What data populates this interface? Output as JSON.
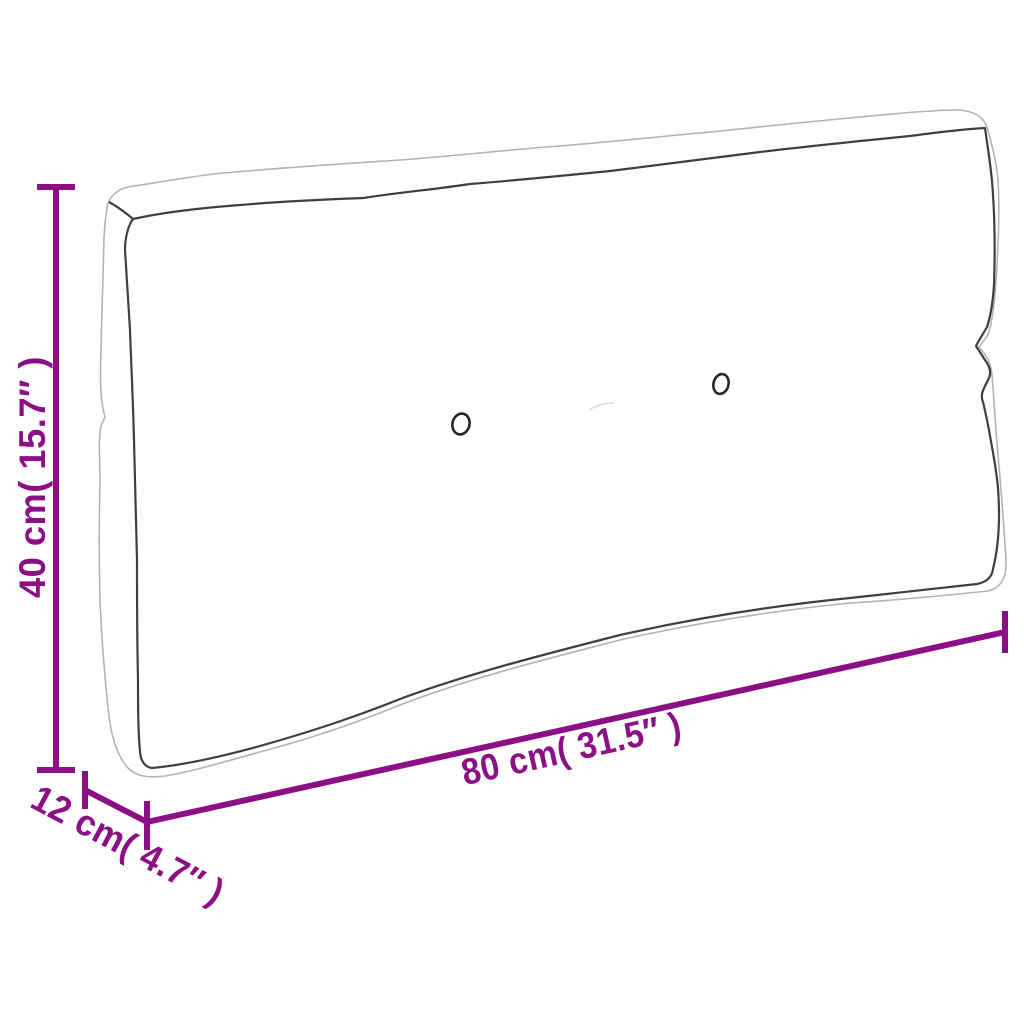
{
  "diagram": {
    "product": "pallet-cushion",
    "dimensions": {
      "height": {
        "label": "40 cm( 15.7″ )",
        "cm": 40,
        "inches": 15.7
      },
      "length": {
        "label": "80 cm( 31.5″ )",
        "cm": 80,
        "inches": 31.5
      },
      "depth": {
        "label": "12 cm( 4.7″ )",
        "cm": 12,
        "inches": 4.7
      }
    },
    "button_count": 2
  },
  "colors": {
    "accent": "#8C0F86",
    "cushion_outer_outline": "#b3b3b3",
    "cushion_seam": "#3f3f3f",
    "button_stroke": "#262626",
    "background": "#ffffff"
  }
}
